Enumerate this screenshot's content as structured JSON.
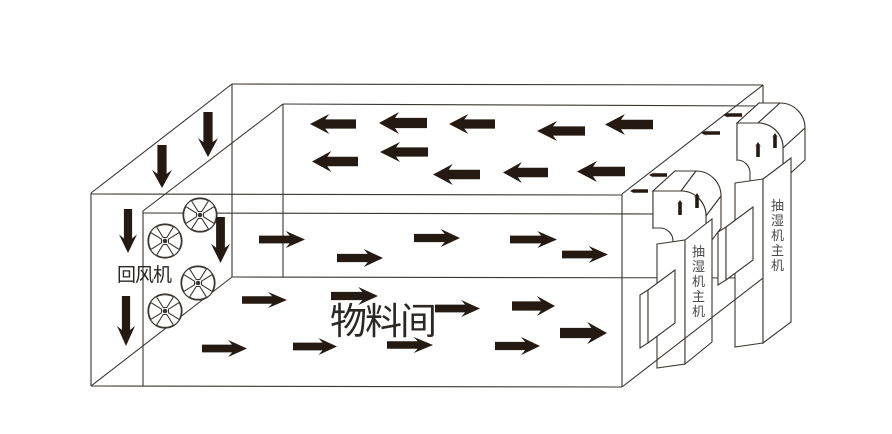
{
  "labels": {
    "wall_fan": "回风机",
    "room": "物料间",
    "unit": "抽湿机主机"
  },
  "colors": {
    "background": "#ffffff",
    "line": "#3b3631",
    "arrow": "#241a11",
    "text_dark": "#2b2724",
    "text_gray": "#4a4a4a"
  },
  "room": {
    "lines": [
      [
        232,
        84,
        763,
        85
      ],
      [
        232,
        84,
        91,
        193
      ],
      [
        763,
        85,
        622,
        194
      ],
      [
        91,
        193,
        91,
        386
      ],
      [
        91,
        194,
        622,
        195
      ],
      [
        91,
        386,
        622,
        387
      ],
      [
        622,
        194,
        622,
        387
      ],
      [
        232,
        84,
        232,
        277
      ],
      [
        91,
        386,
        232,
        277
      ],
      [
        232,
        277,
        763,
        278
      ],
      [
        763,
        85,
        763,
        278
      ],
      [
        283,
        104,
        143,
        211
      ],
      [
        283,
        104,
        760,
        106
      ],
      [
        143,
        211,
        143,
        386
      ],
      [
        143,
        213,
        660,
        214
      ],
      [
        283,
        104,
        283,
        277
      ]
    ],
    "overlay_lines": [
      [
        622,
        387,
        763,
        278
      ]
    ]
  },
  "texts": [
    {
      "name": "return-fan-label",
      "bind": "labels.wall_fan",
      "x": 117,
      "y": 281,
      "size": 19,
      "spacing": -1,
      "color": "text_dark"
    },
    {
      "name": "material-room-label",
      "bind": "labels.room",
      "x": 330,
      "y": 334,
      "size": 37,
      "spacing": -2,
      "color": "text_dark"
    }
  ],
  "fans": {
    "radius": 17,
    "centers": [
      [
        200,
        215
      ],
      [
        165,
        241
      ],
      [
        198,
        283
      ],
      [
        165,
        311
      ]
    ]
  },
  "flow_arrows": {
    "plenum_left": [
      [
        310,
        114,
        46,
        20
      ],
      [
        379,
        112,
        48,
        22
      ],
      [
        449,
        114,
        46,
        20
      ],
      [
        537,
        121,
        48,
        20
      ],
      [
        605,
        114,
        48,
        21
      ],
      [
        312,
        151,
        46,
        21
      ],
      [
        380,
        142,
        48,
        20
      ],
      [
        433,
        164,
        47,
        21
      ],
      [
        503,
        162,
        45,
        21
      ],
      [
        577,
        161,
        48,
        21
      ]
    ],
    "mid_right": [
      [
        259,
        231,
        46,
        17
      ],
      [
        337,
        249,
        46,
        18
      ],
      [
        414,
        229,
        46,
        18
      ],
      [
        510,
        231,
        47,
        17
      ],
      [
        562,
        246,
        46,
        17
      ]
    ],
    "bottom_right": [
      [
        242,
        292,
        45,
        16
      ],
      [
        202,
        340,
        45,
        17
      ],
      [
        293,
        338,
        44,
        17
      ],
      [
        331,
        287,
        47,
        18
      ],
      [
        435,
        300,
        45,
        17
      ],
      [
        387,
        337,
        46,
        16
      ],
      [
        495,
        337,
        45,
        18
      ],
      [
        512,
        296,
        43,
        20
      ],
      [
        560,
        322,
        47,
        22
      ]
    ],
    "down_left_wall": [
      [
        152,
        145,
        20,
        43
      ],
      [
        198,
        112,
        20,
        45
      ],
      [
        119,
        209,
        18,
        44
      ],
      [
        117,
        296,
        18,
        50
      ],
      [
        211,
        217,
        19,
        46
      ]
    ]
  },
  "units": [
    {
      "name": "dehumidifier-unit-1",
      "shapes": [
        {
          "name": "duct-exit-face",
          "d": "M653,191 L675,171 L675,208 L653,228 Z"
        },
        {
          "name": "duct-top-face",
          "d": "M653,191 L675,171 L696,171 L681,191 Z"
        },
        {
          "name": "duct-outer-face",
          "d": "M681,191 A25,25 0 0 1 706,216 L721,196 A25,25 0 0 0 696,171 Z"
        },
        {
          "name": "duct-side-face",
          "d": "M706,216 L721,196 L721,228 L706,248 Z"
        },
        {
          "name": "duct-front-profile",
          "d": "M653,191 L681,191 A25,25 0 0 1 706,216 L706,248 L673,248 L673,241 A13,13 0 0 0 660,228 L653,228 Z"
        },
        {
          "name": "body-front-face",
          "d": "M657,244 L685,240 L685,364 L657,368 Z"
        },
        {
          "name": "body-side-panel",
          "d": "M685,240 L712,219 L712,342 L685,364 Z"
        },
        {
          "name": "vent-side-strip",
          "d": "M640,295 L648,290 L648,343 L640,348 Z"
        },
        {
          "name": "vent-front-face",
          "d": "M648,290 L675,270 L675,323 L648,343 Z"
        }
      ],
      "up_arrows": [
        [
          676,
          200,
          8,
          15
        ],
        [
          693,
          193,
          8,
          15
        ]
      ],
      "out_arrows": [
        [
          649,
          171,
          18,
          8
        ],
        [
          630,
          187,
          18,
          8
        ]
      ],
      "label_x": 698.5,
      "label_y": 256,
      "label_dy": 15,
      "label_size": 13
    },
    {
      "name": "dehumidifier-unit-2",
      "shapes": [
        {
          "name": "duct-exit-face",
          "d": "M737,123 L759,103 L759,140 L737,160 Z"
        },
        {
          "name": "duct-top-face",
          "d": "M737,123 L759,103 L780,103 L758,123 Z"
        },
        {
          "name": "duct-outer-face",
          "d": "M758,123 A25,25 0 0 1 783,148 L805,128 A25,25 0 0 0 780,103 Z"
        },
        {
          "name": "duct-side-face",
          "d": "M783,148 L805,128 L805,160 L783,180 Z"
        },
        {
          "name": "duct-front-profile",
          "d": "M737,123 L758,123 A25,25 0 0 1 783,148 L783,183 L750,183 L750,173 A13,13 0 0 0 737,160 Z"
        },
        {
          "name": "body-front-face",
          "d": "M735,183 L763,179 L763,343 L735,347 Z"
        },
        {
          "name": "body-side-panel",
          "d": "M763,179 L791,158 L791,322 L763,343 Z"
        },
        {
          "name": "vent-side-strip",
          "d": "M718,232 L726,227 L726,280 L718,285 Z"
        },
        {
          "name": "vent-front-face",
          "d": "M726,227 L753,207 L753,260 L726,280 Z"
        }
      ],
      "up_arrows": [
        [
          754,
          142,
          8,
          15
        ],
        [
          771,
          133,
          8,
          15
        ]
      ],
      "out_arrows": [
        [
          723,
          111,
          19,
          8
        ],
        [
          701,
          129,
          19,
          8
        ]
      ],
      "label_x": 777.5,
      "label_y": 210,
      "label_dy": 15,
      "label_size": 13
    }
  ]
}
